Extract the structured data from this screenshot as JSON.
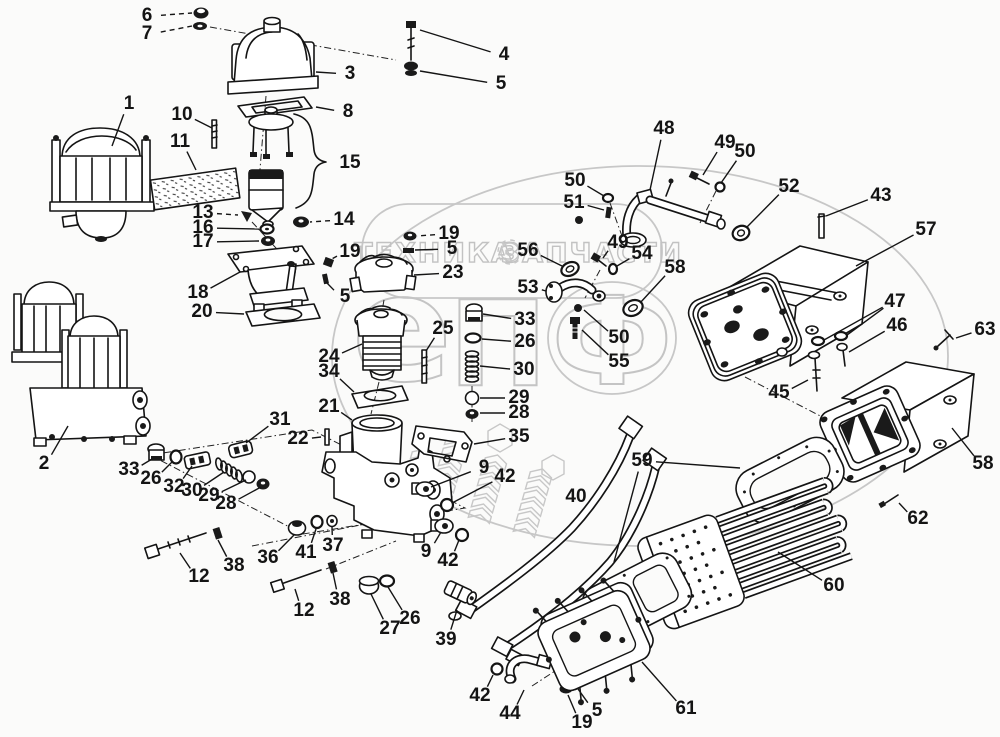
{
  "watermark": {
    "left_text": "ТЕХНИКА",
    "right_text": "ЗАПЧАСТИ",
    "gear_icon": "gear",
    "letters": [
      "е",
      "П",
      "Ф"
    ],
    "color": "#c7c7c7"
  },
  "diagram": {
    "type": "exploded-parts-diagram",
    "line_color": "#141414",
    "background": "#fbfbfa",
    "labels": [
      {
        "n": "6",
        "x": 147,
        "y": 16,
        "t": [
          [
            192,
            13
          ]
        ],
        "d": true
      },
      {
        "n": "7",
        "x": 147,
        "y": 34,
        "t": [
          [
            192,
            26
          ]
        ],
        "d": true
      },
      {
        "n": "1",
        "x": 129,
        "y": 104,
        "t": [
          [
            112,
            146
          ]
        ]
      },
      {
        "n": "3",
        "x": 350,
        "y": 74,
        "t": [
          [
            316,
            72
          ]
        ]
      },
      {
        "n": "8",
        "x": 348,
        "y": 112,
        "t": [
          [
            316,
            107
          ]
        ]
      },
      {
        "n": "15",
        "x": 350,
        "y": 163
      },
      {
        "n": "4",
        "x": 504,
        "y": 55,
        "t": [
          [
            420,
            30
          ]
        ]
      },
      {
        "n": "5",
        "x": 501,
        "y": 84,
        "t": [
          [
            420,
            71
          ]
        ]
      },
      {
        "n": "10",
        "x": 182,
        "y": 115,
        "t": [
          [
            212,
            128
          ]
        ]
      },
      {
        "n": "11",
        "x": 180,
        "y": 142,
        "t": [
          [
            196,
            170
          ]
        ]
      },
      {
        "n": "13",
        "x": 203,
        "y": 213,
        "t": [
          [
            238,
            215
          ]
        ],
        "d": true
      },
      {
        "n": "16",
        "x": 203,
        "y": 228,
        "t": [
          [
            259,
            229
          ]
        ]
      },
      {
        "n": "17",
        "x": 203,
        "y": 242,
        "t": [
          [
            259,
            241
          ]
        ]
      },
      {
        "n": "14",
        "x": 344,
        "y": 220,
        "t": [
          [
            310,
            222
          ]
        ],
        "d": true
      },
      {
        "n": "18",
        "x": 198,
        "y": 293,
        "t": [
          [
            240,
            272
          ]
        ]
      },
      {
        "n": "20",
        "x": 202,
        "y": 312,
        "t": [
          [
            244,
            314
          ]
        ]
      },
      {
        "n": "19",
        "x": 350,
        "y": 252,
        "t": [
          [
            330,
            260
          ]
        ],
        "d": true
      },
      {
        "n": "5",
        "x": 345,
        "y": 297,
        "t": [
          [
            326,
            282
          ]
        ]
      },
      {
        "n": "19",
        "x": 449,
        "y": 234,
        "t": [
          [
            417,
            236
          ]
        ],
        "d": true
      },
      {
        "n": "5",
        "x": 452,
        "y": 249,
        "t": [
          [
            415,
            250
          ]
        ]
      },
      {
        "n": "23",
        "x": 453,
        "y": 273,
        "t": [
          [
            414,
            275
          ]
        ]
      },
      {
        "n": "25",
        "x": 443,
        "y": 329,
        "t": [
          [
            426,
            351
          ]
        ]
      },
      {
        "n": "24",
        "x": 329,
        "y": 357,
        "t": [
          [
            362,
            344
          ]
        ]
      },
      {
        "n": "34",
        "x": 329,
        "y": 372,
        "t": [
          [
            354,
            392
          ]
        ]
      },
      {
        "n": "21",
        "x": 329,
        "y": 407,
        "t": [
          [
            352,
            420
          ]
        ]
      },
      {
        "n": "22",
        "x": 298,
        "y": 439,
        "t": [
          [
            321,
            437
          ]
        ]
      },
      {
        "n": "31",
        "x": 280,
        "y": 420,
        "t": [
          [
            246,
            443
          ]
        ]
      },
      {
        "n": "2",
        "x": 44,
        "y": 464,
        "t": [
          [
            68,
            426
          ]
        ]
      },
      {
        "n": "33",
        "x": 129,
        "y": 470,
        "t": [
          [
            152,
            459
          ]
        ]
      },
      {
        "n": "26",
        "x": 151,
        "y": 479,
        "t": [
          [
            172,
            462
          ]
        ]
      },
      {
        "n": "32",
        "x": 174,
        "y": 487,
        "t": [
          [
            192,
            466
          ]
        ]
      },
      {
        "n": "30",
        "x": 192,
        "y": 491,
        "t": [
          [
            224,
            472
          ]
        ]
      },
      {
        "n": "29",
        "x": 209,
        "y": 496,
        "t": [
          [
            246,
            480
          ]
        ]
      },
      {
        "n": "28",
        "x": 226,
        "y": 504,
        "t": [
          [
            261,
            487
          ]
        ]
      },
      {
        "n": "12",
        "x": 199,
        "y": 577,
        "t": [
          [
            180,
            553
          ]
        ]
      },
      {
        "n": "38",
        "x": 234,
        "y": 566,
        "t": [
          [
            218,
            540
          ]
        ]
      },
      {
        "n": "36",
        "x": 268,
        "y": 558,
        "t": [
          [
            294,
            535
          ]
        ]
      },
      {
        "n": "41",
        "x": 306,
        "y": 553,
        "t": [
          [
            316,
            529
          ]
        ]
      },
      {
        "n": "37",
        "x": 333,
        "y": 546,
        "t": [
          [
            332,
            527
          ]
        ]
      },
      {
        "n": "12",
        "x": 304,
        "y": 611,
        "t": [
          [
            295,
            589
          ]
        ]
      },
      {
        "n": "38",
        "x": 340,
        "y": 600,
        "t": [
          [
            333,
            573
          ]
        ]
      },
      {
        "n": "27",
        "x": 390,
        "y": 629,
        "t": [
          [
            371,
            594
          ]
        ]
      },
      {
        "n": "26",
        "x": 410,
        "y": 619,
        "t": [
          [
            388,
            587
          ]
        ]
      },
      {
        "n": "39",
        "x": 446,
        "y": 640,
        "t": [
          [
            457,
            610
          ]
        ]
      },
      {
        "n": "9",
        "x": 484,
        "y": 468,
        "t": [
          [
            431,
            487
          ]
        ]
      },
      {
        "n": "42",
        "x": 505,
        "y": 477,
        "t": [
          [
            452,
            503
          ]
        ]
      },
      {
        "n": "9",
        "x": 426,
        "y": 552,
        "t": [
          [
            441,
            532
          ]
        ]
      },
      {
        "n": "42",
        "x": 448,
        "y": 561,
        "t": [
          [
            459,
            540
          ]
        ]
      },
      {
        "n": "35",
        "x": 519,
        "y": 437,
        "t": [
          [
            474,
            444
          ]
        ]
      },
      {
        "n": "29",
        "x": 519,
        "y": 398,
        "t": [
          [
            480,
            398
          ]
        ]
      },
      {
        "n": "28",
        "x": 519,
        "y": 413,
        "t": [
          [
            480,
            413
          ]
        ]
      },
      {
        "n": "33",
        "x": 525,
        "y": 320,
        "t": [
          [
            483,
            314
          ]
        ]
      },
      {
        "n": "26",
        "x": 525,
        "y": 342,
        "t": [
          [
            482,
            339
          ]
        ]
      },
      {
        "n": "30",
        "x": 524,
        "y": 370,
        "t": [
          [
            480,
            366
          ]
        ]
      },
      {
        "n": "40",
        "x": 576,
        "y": 497
      },
      {
        "n": "56",
        "x": 528,
        "y": 251,
        "t": [
          [
            562,
            266
          ]
        ]
      },
      {
        "n": "53",
        "x": 528,
        "y": 288,
        "t": [
          [
            546,
            291
          ]
        ]
      },
      {
        "n": "49",
        "x": 618,
        "y": 243,
        "t": [
          [
            603,
            258
          ]
        ]
      },
      {
        "n": "54",
        "x": 642,
        "y": 254,
        "t": [
          [
            617,
            266
          ]
        ]
      },
      {
        "n": "58",
        "x": 675,
        "y": 268,
        "t": [
          [
            640,
            303
          ]
        ]
      },
      {
        "n": "50",
        "x": 575,
        "y": 181,
        "t": [
          [
            604,
            196
          ]
        ]
      },
      {
        "n": "51",
        "x": 574,
        "y": 203,
        "t": [
          [
            604,
            210
          ]
        ]
      },
      {
        "n": "50",
        "x": 619,
        "y": 338,
        "t": [
          [
            584,
            310
          ]
        ]
      },
      {
        "n": "55",
        "x": 619,
        "y": 362,
        "t": [
          [
            582,
            330
          ]
        ]
      },
      {
        "n": "48",
        "x": 664,
        "y": 129,
        "t": [
          [
            650,
            190
          ]
        ]
      },
      {
        "n": "49",
        "x": 725,
        "y": 143,
        "t": [
          [
            703,
            175
          ]
        ]
      },
      {
        "n": "50",
        "x": 745,
        "y": 152,
        "t": [
          [
            721,
            183
          ]
        ]
      },
      {
        "n": "52",
        "x": 789,
        "y": 187,
        "t": [
          [
            746,
            228
          ]
        ]
      },
      {
        "n": "43",
        "x": 881,
        "y": 196,
        "t": [
          [
            826,
            216
          ]
        ]
      },
      {
        "n": "57",
        "x": 926,
        "y": 230,
        "t": [
          [
            856,
            266
          ]
        ]
      },
      {
        "n": "47",
        "x": 895,
        "y": 302,
        "t": [
          [
            824,
            340
          ],
          [
            847,
            335
          ]
        ]
      },
      {
        "n": "46",
        "x": 897,
        "y": 326,
        "t": [
          [
            849,
            352
          ]
        ]
      },
      {
        "n": "63",
        "x": 985,
        "y": 330,
        "t": [
          [
            956,
            338
          ]
        ]
      },
      {
        "n": "45",
        "x": 779,
        "y": 393,
        "t": [
          [
            808,
            380
          ]
        ]
      },
      {
        "n": "58",
        "x": 983,
        "y": 464,
        "t": [
          [
            952,
            428
          ]
        ]
      },
      {
        "n": "62",
        "x": 918,
        "y": 519,
        "t": [
          [
            899,
            503
          ]
        ]
      },
      {
        "n": "59",
        "x": 642,
        "y": 461,
        "t": [
          [
            740,
            468
          ],
          [
            614,
            562
          ]
        ]
      },
      {
        "n": "60",
        "x": 834,
        "y": 586,
        "t": [
          [
            778,
            552
          ]
        ]
      },
      {
        "n": "61",
        "x": 686,
        "y": 709,
        "t": [
          [
            642,
            662
          ]
        ]
      },
      {
        "n": "44",
        "x": 510,
        "y": 714,
        "t": [
          [
            524,
            690
          ]
        ]
      },
      {
        "n": "42",
        "x": 480,
        "y": 696,
        "t": [
          [
            493,
            675
          ]
        ]
      },
      {
        "n": "19",
        "x": 582,
        "y": 723,
        "t": [
          [
            568,
            695
          ]
        ]
      },
      {
        "n": "5",
        "x": 597,
        "y": 711,
        "t": [
          [
            578,
            689
          ]
        ]
      }
    ]
  }
}
